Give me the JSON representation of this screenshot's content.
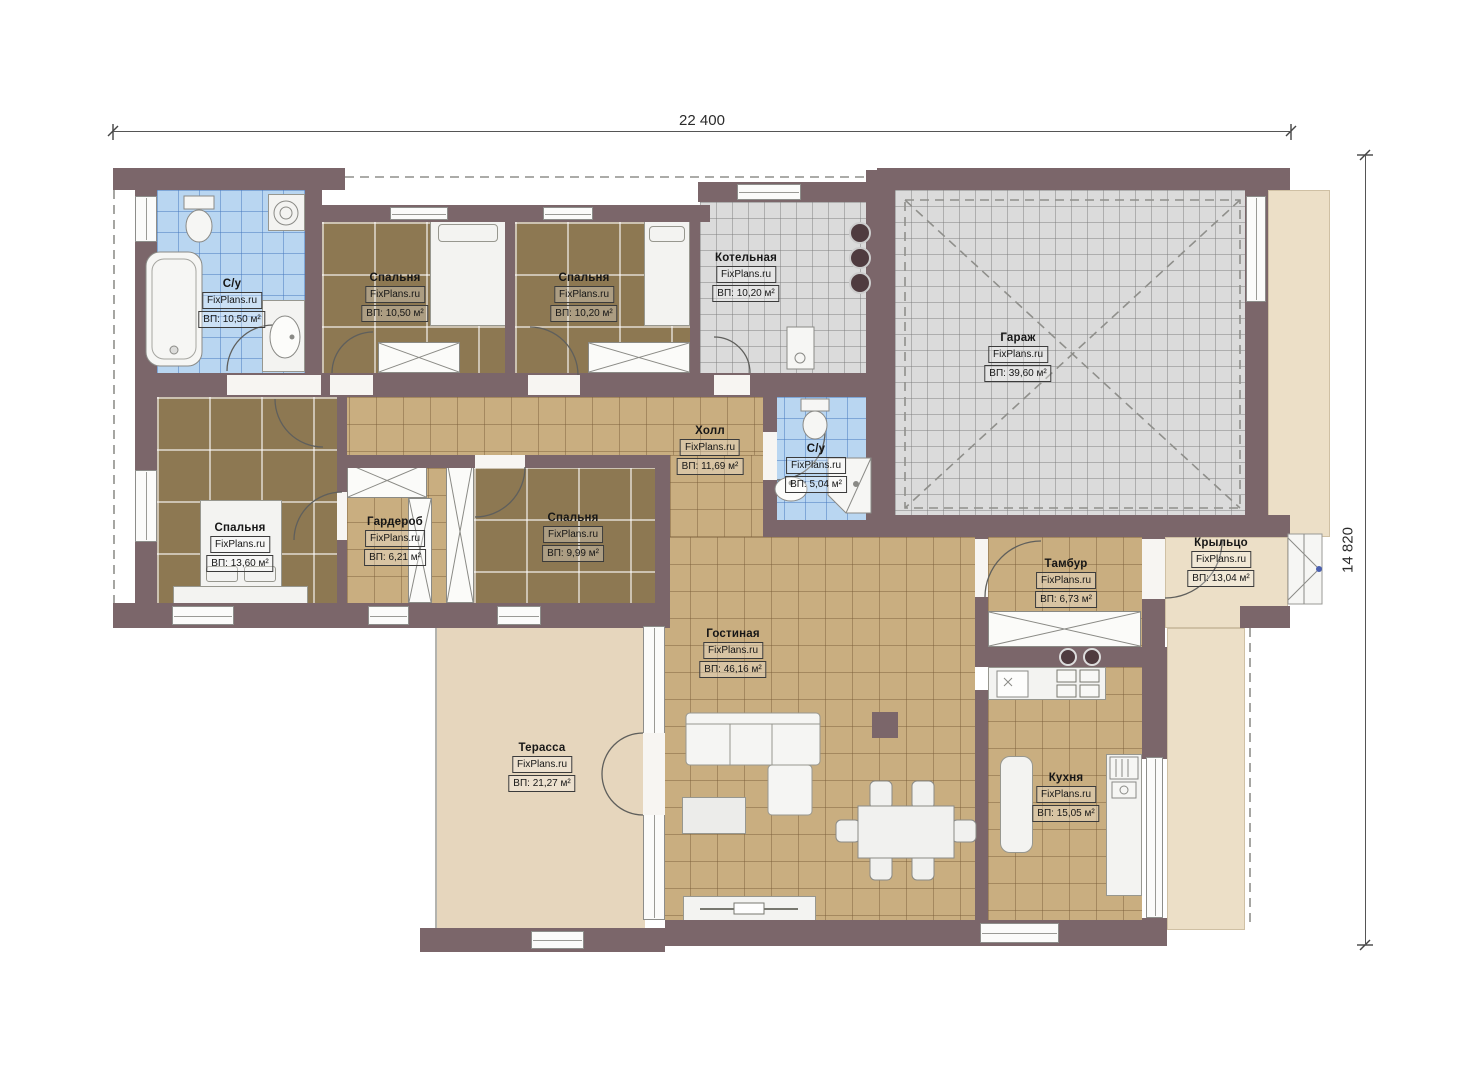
{
  "watermark": "FixPlans.ru",
  "dimensions": {
    "width_label": "22 400",
    "height_label": "14 820"
  },
  "rooms": [
    {
      "id": "bathroom-1",
      "name": "С/у",
      "area": "ВП: 10,50 м²"
    },
    {
      "id": "bedroom-1",
      "name": "Спальня",
      "area": "ВП: 10,50 м²"
    },
    {
      "id": "bedroom-2",
      "name": "Спальня",
      "area": "ВП: 10,20 м²"
    },
    {
      "id": "boiler-room",
      "name": "Котельная",
      "area": "ВП: 10,20 м²"
    },
    {
      "id": "garage",
      "name": "Гараж",
      "area": "ВП: 39,60 м²"
    },
    {
      "id": "hall",
      "name": "Холл",
      "area": "ВП: 11,69 м²"
    },
    {
      "id": "bathroom-2",
      "name": "С/у",
      "area": "ВП: 5,04 м²"
    },
    {
      "id": "bedroom-3",
      "name": "Спальня",
      "area": "ВП: 13,60 м²"
    },
    {
      "id": "wardrobe",
      "name": "Гардероб",
      "area": "ВП: 6,21 м²"
    },
    {
      "id": "bedroom-4",
      "name": "Спальня",
      "area": "ВП: 9,99 м²"
    },
    {
      "id": "tambour",
      "name": "Тамбур",
      "area": "ВП: 6,73 м²"
    },
    {
      "id": "porch",
      "name": "Крыльцо",
      "area": "ВП: 13,04 м²"
    },
    {
      "id": "living-room",
      "name": "Гостиная",
      "area": "ВП: 46,16 м²"
    },
    {
      "id": "terrace",
      "name": "Терасса",
      "area": "ВП: 21,27 м²"
    },
    {
      "id": "kitchen",
      "name": "Кухня",
      "area": "ВП: 15,05 м²"
    }
  ]
}
